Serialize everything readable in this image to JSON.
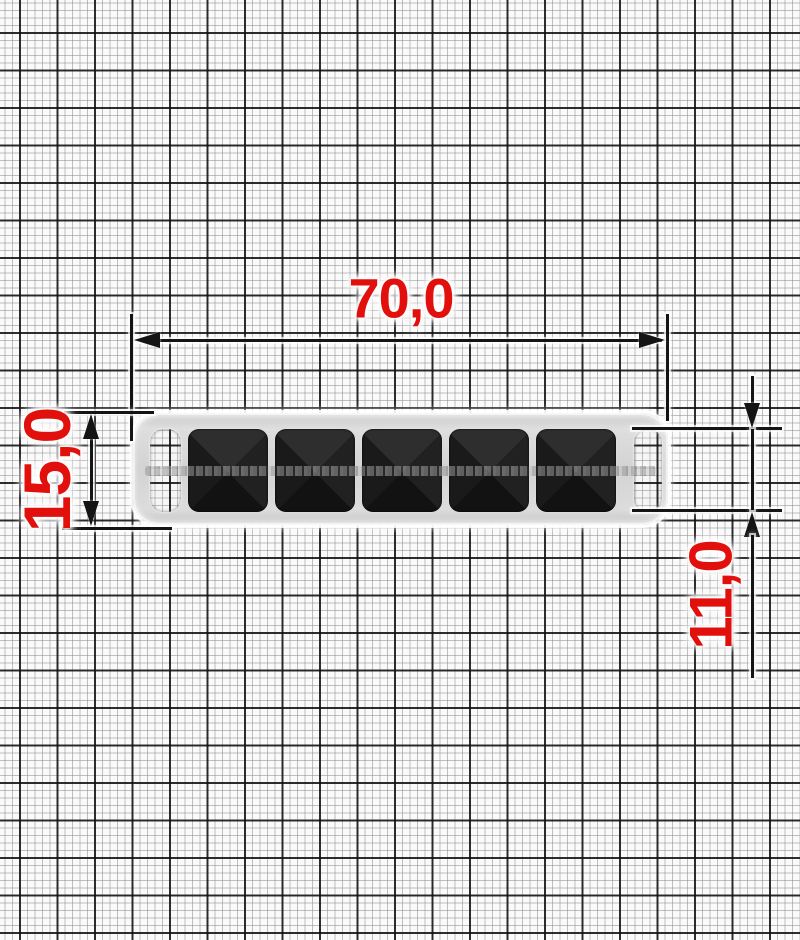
{
  "dimensions": {
    "width": "70,0",
    "height": "15,0",
    "inner_height": "11,0"
  },
  "object": {
    "type": "strap-buckle-frame-with-pyramid-studs",
    "stud_count": 5,
    "end_slots": 2
  },
  "style": {
    "dimension_text_color": "#e2100d",
    "dimension_line_color": "#141414",
    "frame_color": "#d4d4d4",
    "stud_color": "#1c1c1c",
    "paper_color": "#fafafa",
    "grid_major_mm": 5,
    "grid_minor_mm": 1
  }
}
